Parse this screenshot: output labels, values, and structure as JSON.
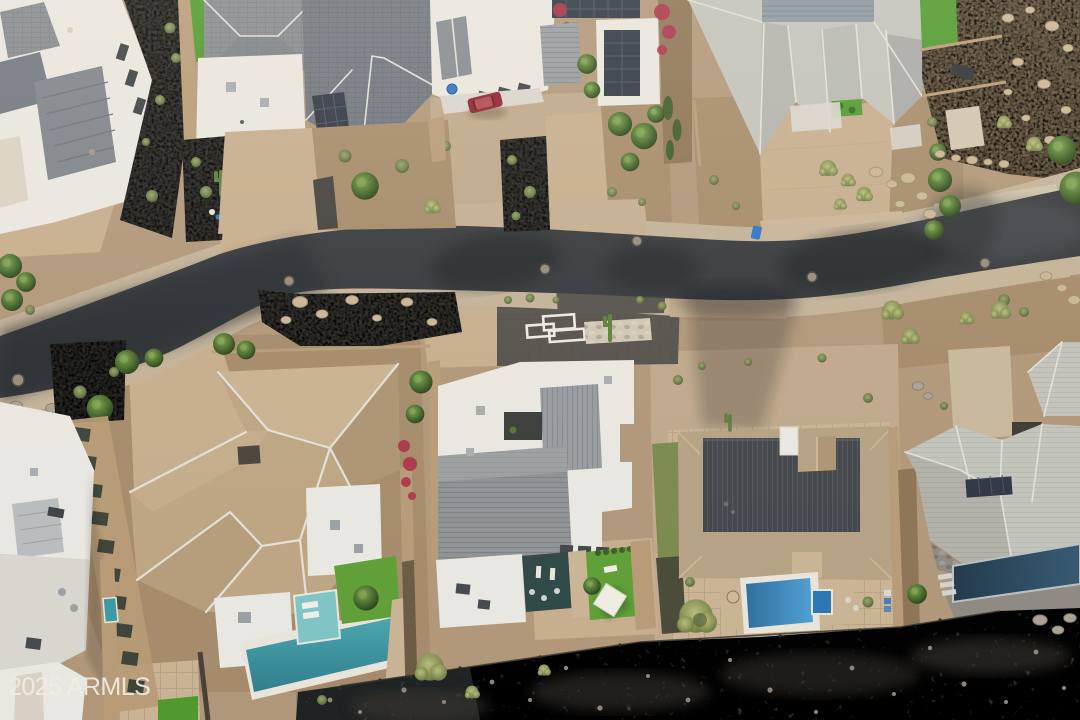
{
  "watermark": {
    "text": "2025 ARMLS"
  },
  "scene": {
    "type": "aerial-drone-photograph",
    "description": "Overhead view of a desert residential street with luxury homes, driveways, swimming pools, desert landscaping and an undeveloped rocky wash along the bottom"
  },
  "palette": {
    "ground": "#b1977a",
    "ground_light": "#c6ad8e",
    "dirt": "#a58b6b",
    "dirt_dark": "#8d7456",
    "asphalt": "#36393d",
    "asphalt_shade": "#24262a",
    "shoulder": "#c3b299",
    "shoulder_pale": "#cfc2ab",
    "gravel": "#44423e",
    "paver_dark": "#56534e",
    "paver_tan": "#bfa88b",
    "travertine": "#c9b394",
    "white_roof": "#e9e7e1",
    "white_dim": "#d9d6cf",
    "gray_roof": "#868b91",
    "gray_roof_dark": "#6f7780",
    "metal_roof": "#979ca0",
    "pale_roof": "#c2c3bb",
    "pale_roof_shade": "#a9aaa3",
    "ridge_cap": "#e2dfd8",
    "tan_roof": "#bda583",
    "tan_roof_light": "#cbb494",
    "tan_roof_dark": "#a78d6c",
    "tan_tile": "#b5a183",
    "charcoal_roof": "#43464a",
    "wall_tan": "#b79b77",
    "turf": "#4f992f",
    "lawn": "#5f9f36",
    "tree_green": "#3d5c2b",
    "sage": "#9aa468",
    "pool_teal": "#3e98a3",
    "pool_teal_light": "#7fc3c6",
    "pool_blue": "#3e8fc9",
    "pool_navy": "#274053",
    "patio_dark": "#2f4946",
    "stone_band": "#8e8a82",
    "rocky": "#55504a",
    "hillside": "#9c825f",
    "watermark_white": "#f0ede6",
    "red_bougainvillea": "#ab3148",
    "red_car": "#8e2230",
    "blue_bin": "#2f74c8",
    "solar_panel": "#2e3744",
    "metal_deck": "#8a98a2"
  }
}
